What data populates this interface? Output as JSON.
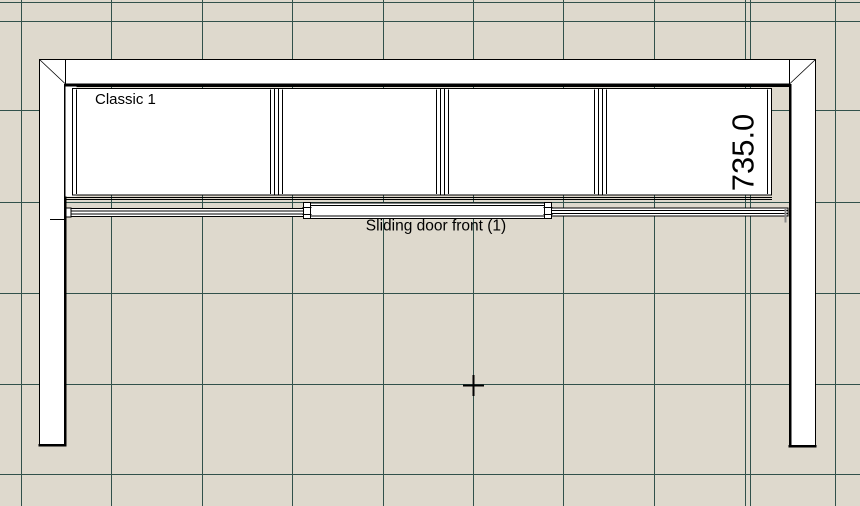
{
  "canvas": {
    "view_type": "plan-view-drawing",
    "labels": {
      "cabinet_name": "Classic 1",
      "width_dimension": "735.0",
      "sliding_door": "Sliding door front (1)"
    },
    "cursor_icon": "crosshair"
  },
  "colors": {
    "background": "#ded9cd",
    "grid_line": "#31514b",
    "outline": "#000000",
    "shape_fill": "#ffffff",
    "detail_gray": "#8a8a8a"
  }
}
